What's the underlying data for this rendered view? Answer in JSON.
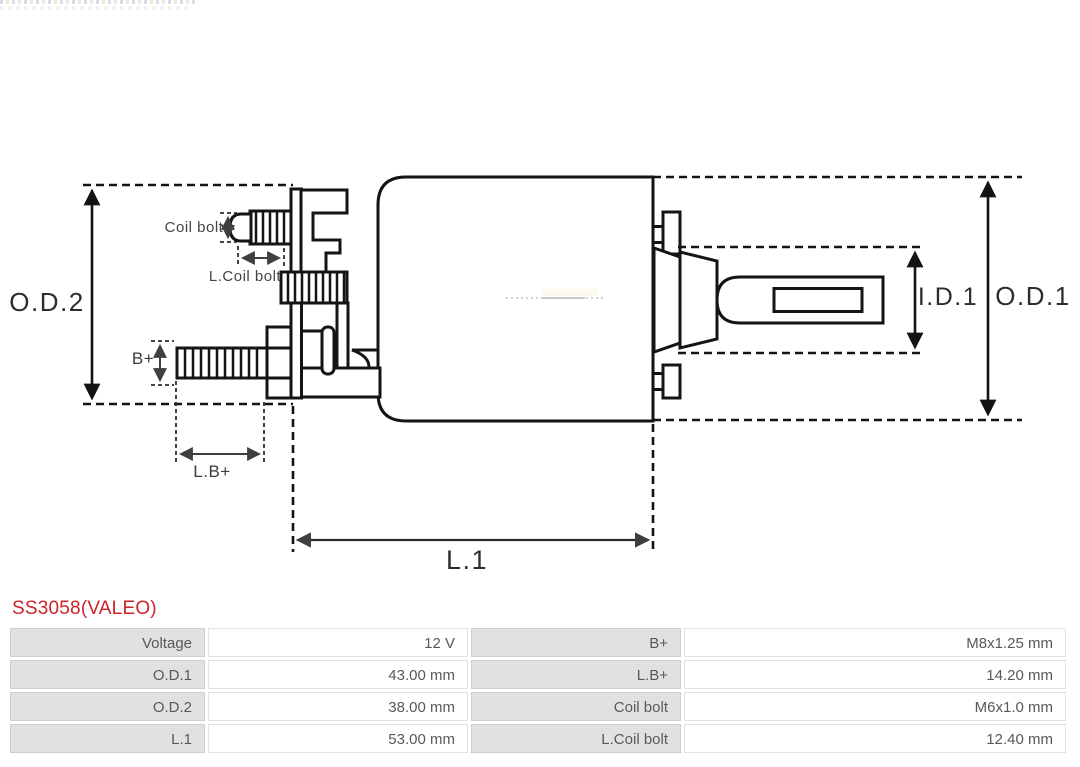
{
  "title": {
    "text": "SS3058(VALEO)",
    "color": "#cb2328"
  },
  "diagram": {
    "labels": {
      "od2": "O.D.2",
      "od1": "O.D.1",
      "id1": "I.D.1",
      "l1": "L.1",
      "b_plus": "B+",
      "lb_plus": "L.B+",
      "coil_bolt": "Coil bolt",
      "l_coil_bolt": "L.Coil bolt"
    }
  },
  "spec_table": {
    "colors": {
      "label_bg": "#e1e1e1",
      "value_bg": "#ffffff",
      "text": "#59595b",
      "border": "#d4d4d4"
    },
    "rows": [
      {
        "label_left": "Voltage",
        "value_left": "12 V",
        "label_right": "B+",
        "value_right": "M8x1.25 mm"
      },
      {
        "label_left": "O.D.1",
        "value_left": "43.00 mm",
        "label_right": "L.B+",
        "value_right": "14.20 mm"
      },
      {
        "label_left": "O.D.2",
        "value_left": "38.00 mm",
        "label_right": "Coil bolt",
        "value_right": "M6x1.0 mm"
      },
      {
        "label_left": "L.1",
        "value_left": "53.00 mm",
        "label_right": "L.Coil bolt",
        "value_right": "12.40 mm"
      }
    ]
  }
}
